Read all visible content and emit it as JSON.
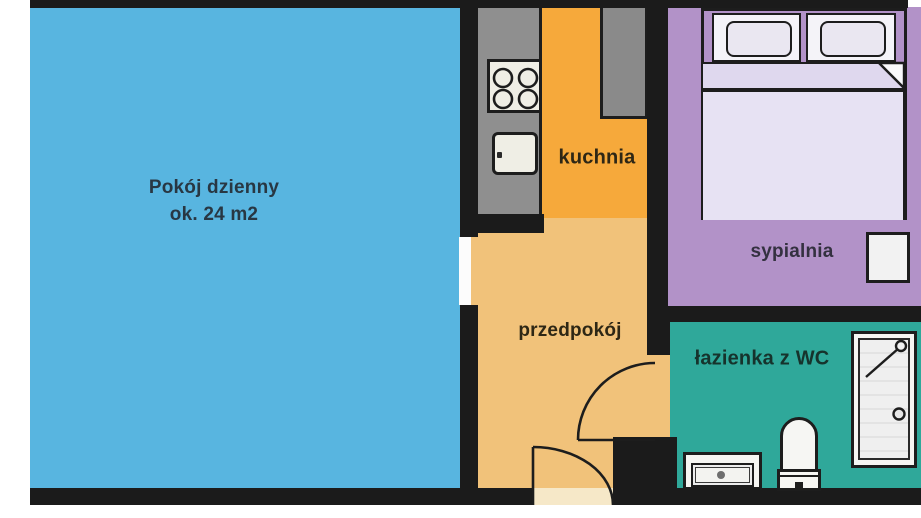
{
  "plan": {
    "title": "apartment-floor-plan",
    "rooms": {
      "living": {
        "label_line1": "Pokój dzienny",
        "label_line2": "ok. 24 m2",
        "color": "#58B5E0",
        "text_color": "#283743"
      },
      "kitchen": {
        "label": "kuchnia",
        "color": "#F6A93B",
        "text_color": "#2E2715"
      },
      "hallway": {
        "label": "przedpokój",
        "color": "#F1C27A",
        "text_color": "#2E2715"
      },
      "bedroom": {
        "label": "sypialnia",
        "color": "#B292C8",
        "text_color": "#343140"
      },
      "bathroom": {
        "label": "łazienka z WC",
        "color": "#2FA89A",
        "text_color": "#16332C"
      }
    },
    "palette": {
      "wall": "#1B1B1B",
      "outline": "#1D1D1D",
      "counter_gray": "#8F8F8F",
      "cabinet_gray": "#8A8A8A",
      "fixture_white": "#F6F6F3",
      "fixture_inner": "#EDEDED",
      "stove_plate": "#EFEEE5",
      "bed_mattress": "#E7E2F3",
      "bed_blanket": "#DFD8EE",
      "pillow_frame": "#F4F3F8",
      "pillow": "#EAE7F1",
      "nightstand": "#F2F2F2",
      "doorway_white": "#FCFCFC",
      "threshold": "#F6E8C8",
      "page": "#FFFFFF"
    },
    "fixtures": [
      "stove-icon",
      "kitchen-sink-icon",
      "tall-cabinet-icon",
      "kitchen-counter",
      "double-bed",
      "pillow",
      "blanket",
      "blanket-fold",
      "nightstand",
      "bathtub-icon",
      "toilet-icon",
      "washbasin-icon",
      "bathroom-door-swing",
      "entrance-door-swing",
      "living-room-doorway"
    ]
  }
}
